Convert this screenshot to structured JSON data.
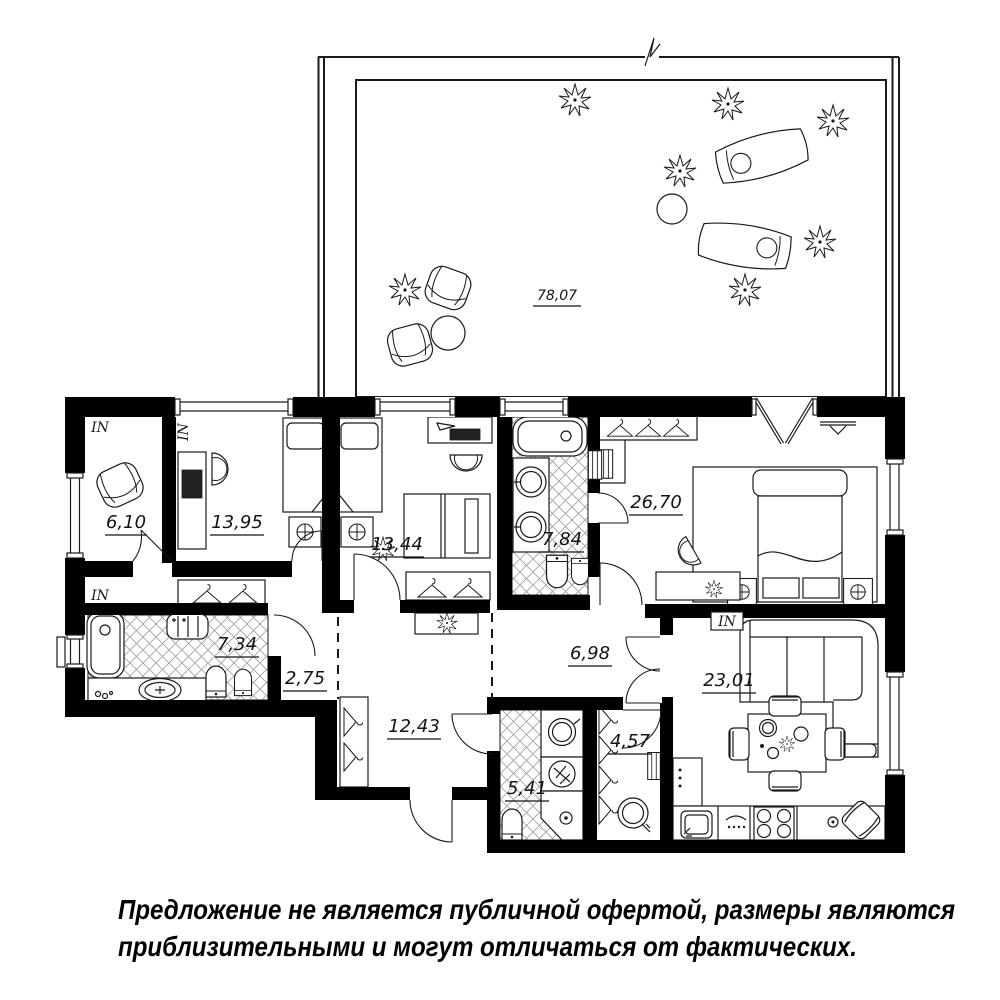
{
  "plan": {
    "rooms": {
      "terrace": {
        "area": "78,07"
      },
      "cabinet": {
        "area": "6,10"
      },
      "bedroom_a": {
        "area": "13,95"
      },
      "bedroom_b": {
        "area": "13,44"
      },
      "bath_a": {
        "area": "7,84"
      },
      "bedroom_master": {
        "area": "26,70"
      },
      "bath_b": {
        "area": "7,34"
      },
      "hall_small": {
        "area": "2,75"
      },
      "hallway": {
        "area": "12,43"
      },
      "corridor": {
        "area": "6,98"
      },
      "wc": {
        "area": "5,41"
      },
      "dressing": {
        "area": "4,57"
      },
      "kitchen_living": {
        "area": "23,01"
      }
    },
    "vents": {
      "k1": "IN",
      "k2": "IN",
      "k3": "IN",
      "k4": "IN"
    },
    "colors": {
      "wall": "#000000",
      "line": "#1a1a1a",
      "hatch": "#9f9f9f",
      "background": "#ffffff"
    }
  },
  "disclaimer": {
    "line1": "Предложение не является публичной офертой, размеры являются",
    "line2": "приблизительными и могут отличаться от фактических."
  }
}
